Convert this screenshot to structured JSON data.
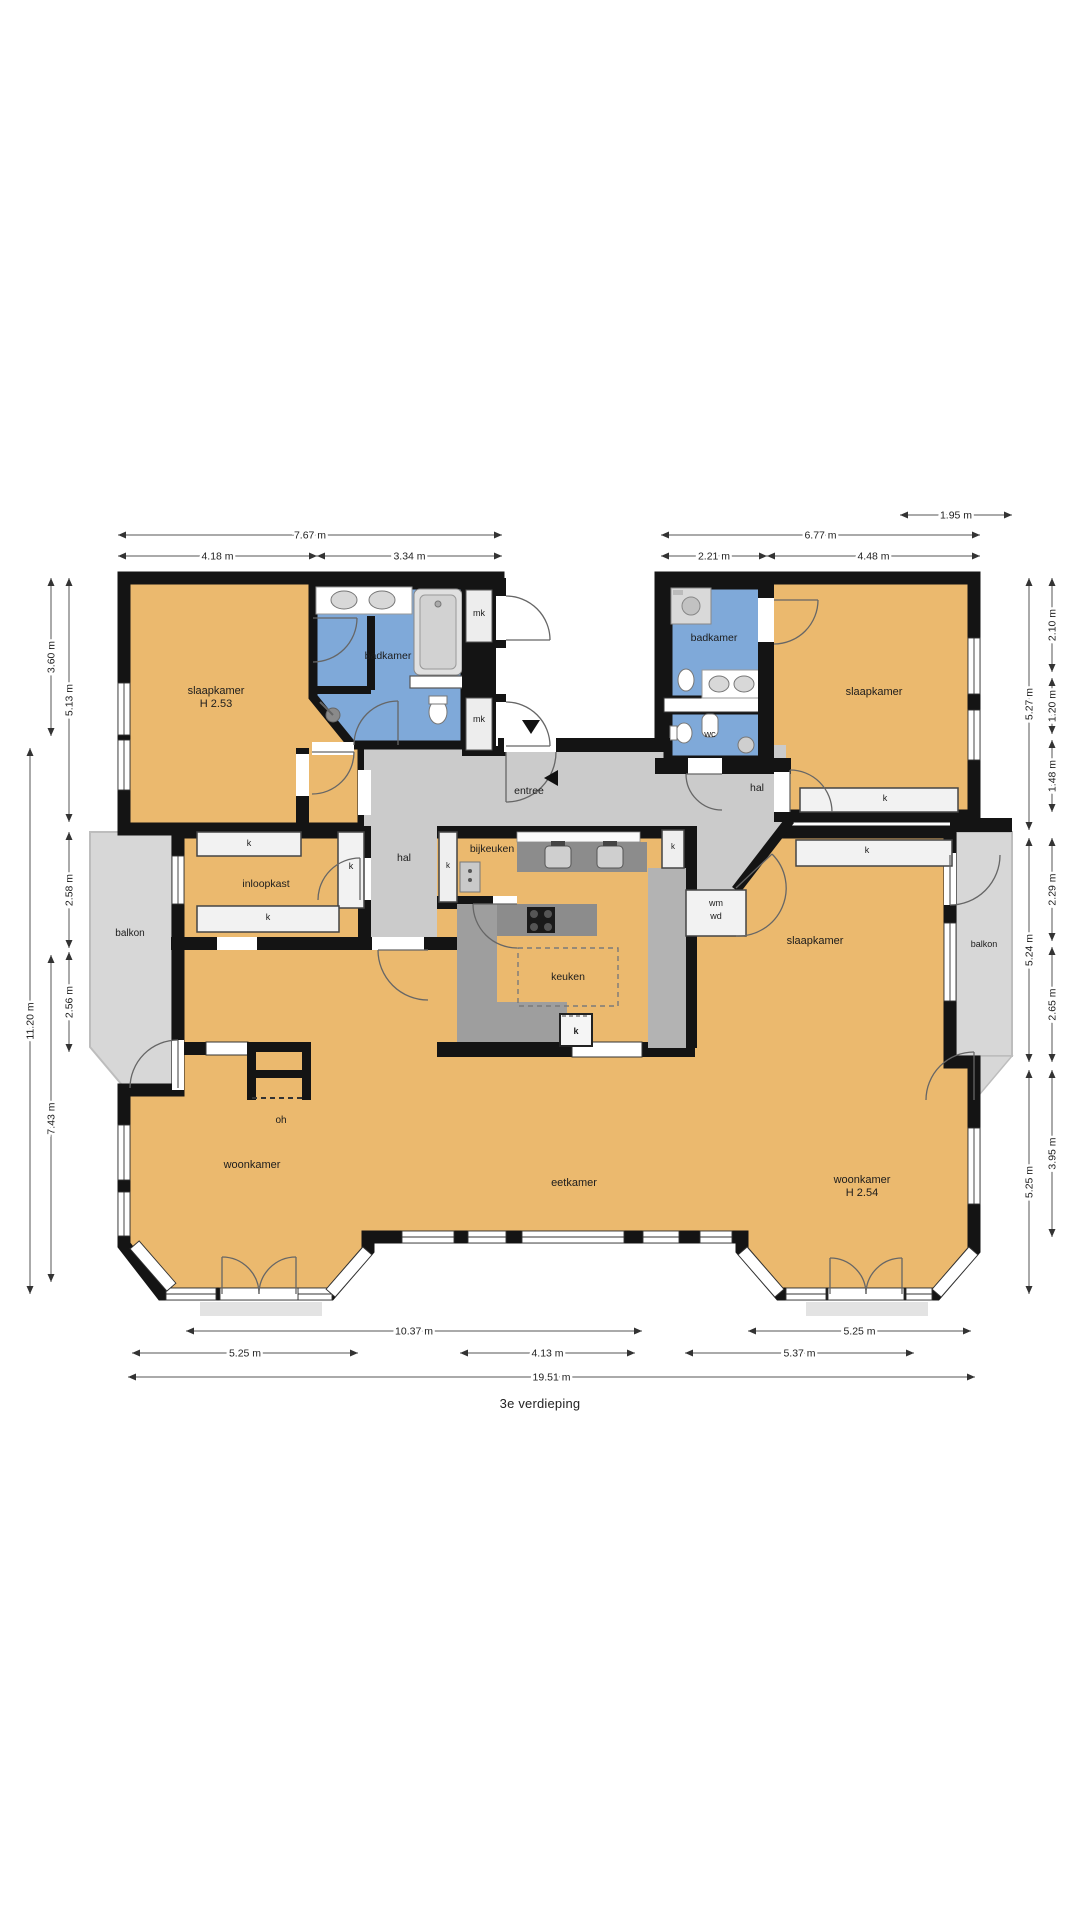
{
  "title": {
    "text": "3e verdieping"
  },
  "colors": {
    "wall": "#141414",
    "room_orange": "#EBB96E",
    "bath_blue": "#7FA9D9",
    "hall_gray": "#CBCBCB",
    "balcony_gray": "#D7D7D7",
    "counter_dark": "#8C8C8C",
    "walkway_gray": "#9E9E9E",
    "strip_gray": "#B3B3B3"
  },
  "floorplan": {
    "room_labels": [
      {
        "id": "slaapkamer-left",
        "lines": [
          "slaapkamer",
          "H 2.53"
        ],
        "x": 216,
        "y": 694,
        "size": 11
      },
      {
        "id": "badkamer-left",
        "lines": [
          "badkamer"
        ],
        "x": 388,
        "y": 659,
        "size": 10.5
      },
      {
        "id": "mk-top",
        "lines": [
          "mk"
        ],
        "x": 479,
        "y": 616,
        "size": 9
      },
      {
        "id": "mk-bottom",
        "lines": [
          "mk"
        ],
        "x": 479,
        "y": 722,
        "size": 9
      },
      {
        "id": "entree",
        "lines": [
          "entree"
        ],
        "x": 529,
        "y": 794,
        "size": 10.5
      },
      {
        "id": "badkamer-right",
        "lines": [
          "badkamer"
        ],
        "x": 714,
        "y": 641,
        "size": 10.5
      },
      {
        "id": "wc",
        "lines": [
          "wc"
        ],
        "x": 710,
        "y": 737,
        "size": 9.5
      },
      {
        "id": "slaapkamer-topright",
        "lines": [
          "slaapkamer"
        ],
        "x": 874,
        "y": 695,
        "size": 11
      },
      {
        "id": "kast-topright",
        "lines": [
          "k"
        ],
        "x": 885,
        "y": 801,
        "size": 9
      },
      {
        "id": "hal-right",
        "lines": [
          "hal"
        ],
        "x": 757,
        "y": 791,
        "size": 10.5
      },
      {
        "id": "kast-midright",
        "lines": [
          "k"
        ],
        "x": 867,
        "y": 853,
        "size": 9
      },
      {
        "id": "wasmachine-droger",
        "lines": [
          "wm",
          "wd"
        ],
        "x": 716,
        "y": 906,
        "size": 9
      },
      {
        "id": "slaapkamer-mid",
        "lines": [
          "slaapkamer"
        ],
        "x": 815,
        "y": 944,
        "size": 11
      },
      {
        "id": "balkon-right",
        "lines": [
          "balkon"
        ],
        "x": 984,
        "y": 947,
        "size": 9
      },
      {
        "id": "balkon-left",
        "lines": [
          "balkon"
        ],
        "x": 130,
        "y": 936,
        "size": 10
      },
      {
        "id": "kast-inloop-top",
        "lines": [
          "k"
        ],
        "x": 249,
        "y": 846,
        "size": 9
      },
      {
        "id": "inloopkast",
        "lines": [
          "inloopkast"
        ],
        "x": 266,
        "y": 887,
        "size": 10.5
      },
      {
        "id": "kast-inloop-right",
        "lines": [
          "k"
        ],
        "x": 351,
        "y": 869,
        "size": 9
      },
      {
        "id": "kast-inloop-bottom",
        "lines": [
          "k"
        ],
        "x": 268,
        "y": 920,
        "size": 9
      },
      {
        "id": "hal-left",
        "lines": [
          "hal"
        ],
        "x": 404,
        "y": 861,
        "size": 10.5
      },
      {
        "id": "kast-hal",
        "lines": [
          "k"
        ],
        "x": 448,
        "y": 868,
        "size": 8
      },
      {
        "id": "kast-keuken-oost",
        "lines": [
          "k"
        ],
        "x": 673,
        "y": 849,
        "size": 8
      },
      {
        "id": "bijkeuken",
        "lines": [
          "bijkeuken"
        ],
        "x": 492,
        "y": 852,
        "size": 10.5
      },
      {
        "id": "keuken",
        "lines": [
          "keuken"
        ],
        "x": 568,
        "y": 980,
        "size": 10.5
      },
      {
        "id": "kast-keuken",
        "lines": [
          "k"
        ],
        "x": 576,
        "y": 1034,
        "size": 9,
        "bold": true
      },
      {
        "id": "open-haard",
        "lines": [
          "oh"
        ],
        "x": 281,
        "y": 1123,
        "size": 10
      },
      {
        "id": "woonkamer-left",
        "lines": [
          "woonkamer"
        ],
        "x": 252,
        "y": 1168,
        "size": 11
      },
      {
        "id": "eetkamer",
        "lines": [
          "eetkamer"
        ],
        "x": 574,
        "y": 1186,
        "size": 11
      },
      {
        "id": "woonkamer-right",
        "lines": [
          "woonkamer",
          "H 2.54"
        ],
        "x": 862,
        "y": 1183,
        "size": 11
      }
    ],
    "dimensions": {
      "horizontal": [
        {
          "label": "1.95 m",
          "x1": 900,
          "x2": 1012,
          "y": 515
        },
        {
          "label": "7.67 m",
          "x1": 118,
          "x2": 502,
          "y": 535
        },
        {
          "label": "6.77 m",
          "x1": 661,
          "x2": 980,
          "y": 535
        },
        {
          "label": "4.18 m",
          "x1": 118,
          "x2": 317,
          "y": 556
        },
        {
          "label": "3.34 m",
          "x1": 317,
          "x2": 502,
          "y": 556
        },
        {
          "label": "2.21 m",
          "x1": 661,
          "x2": 767,
          "y": 556
        },
        {
          "label": "4.48 m",
          "x1": 767,
          "x2": 980,
          "y": 556
        },
        {
          "label": "10.37 m",
          "x1": 186,
          "x2": 642,
          "y": 1331
        },
        {
          "label": "5.25 m",
          "x1": 748,
          "x2": 971,
          "y": 1331
        },
        {
          "label": "5.25 m",
          "x1": 132,
          "x2": 358,
          "y": 1353
        },
        {
          "label": "4.13 m",
          "x1": 460,
          "x2": 635,
          "y": 1353
        },
        {
          "label": "5.37 m",
          "x1": 685,
          "x2": 914,
          "y": 1353
        },
        {
          "label": "19.51 m",
          "x1": 128,
          "x2": 975,
          "y": 1377
        }
      ],
      "vertical": [
        {
          "label": "3.60 m",
          "x": 51,
          "y1": 578,
          "y2": 736
        },
        {
          "label": "5.13 m",
          "x": 69,
          "y1": 578,
          "y2": 822
        },
        {
          "label": "2.58 m",
          "x": 69,
          "y1": 832,
          "y2": 948
        },
        {
          "label": "2.56 m",
          "x": 69,
          "y1": 952,
          "y2": 1052
        },
        {
          "label": "7.43 m",
          "x": 51,
          "y1": 955,
          "y2": 1282
        },
        {
          "label": "11.20 m",
          "x": 30,
          "y1": 748,
          "y2": 1294
        },
        {
          "label": "5.27 m",
          "x": 1029,
          "y1": 578,
          "y2": 830
        },
        {
          "label": "2.10 m",
          "x": 1052,
          "y1": 578,
          "y2": 672
        },
        {
          "label": "1.20 m",
          "x": 1052,
          "y1": 678,
          "y2": 734
        },
        {
          "label": "1.48 m",
          "x": 1052,
          "y1": 740,
          "y2": 812
        },
        {
          "label": "5.24 m",
          "x": 1029,
          "y1": 838,
          "y2": 1062
        },
        {
          "label": "2.29 m",
          "x": 1052,
          "y1": 838,
          "y2": 941
        },
        {
          "label": "2.65 m",
          "x": 1052,
          "y1": 947,
          "y2": 1062
        },
        {
          "label": "5.25 m",
          "x": 1029,
          "y1": 1070,
          "y2": 1294
        },
        {
          "label": "3.95 m",
          "x": 1052,
          "y1": 1070,
          "y2": 1237
        }
      ]
    }
  }
}
